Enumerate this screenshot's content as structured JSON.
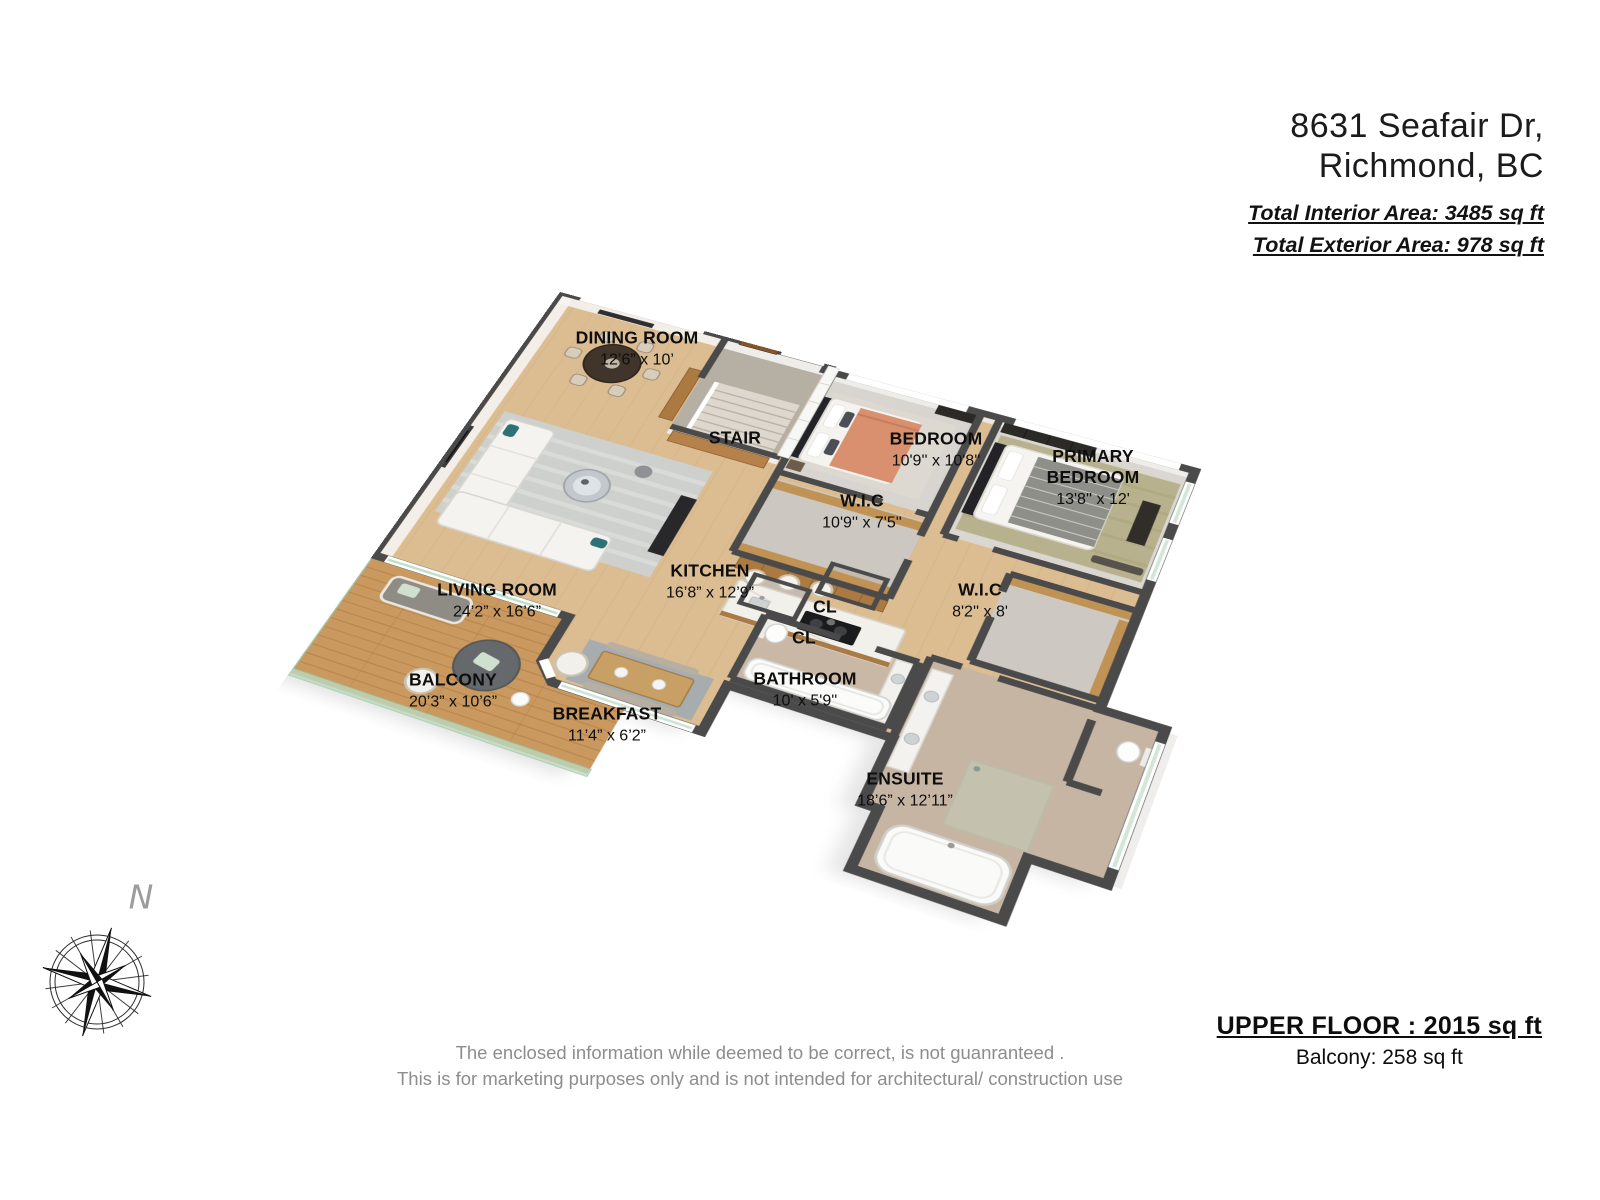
{
  "header": {
    "address_line1": "8631 Seafair Dr,",
    "address_line2": "Richmond, BC",
    "total_interior": "Total Interior Area: 3485 sq ft",
    "total_exterior": "Total Exterior Area: 978 sq ft"
  },
  "rooms": [
    {
      "name": "DINING ROOM",
      "dims": "12’6” x 10’"
    },
    {
      "name": "STAIR",
      "dims": ""
    },
    {
      "name": "BEDROOM",
      "dims": "10'9'' x 10'8''"
    },
    {
      "name": "PRIMARY BEDROOM",
      "dims": "13'8'' x 12'"
    },
    {
      "name": "W.I.C",
      "dims": "10'9'' x 7'5''"
    },
    {
      "name": "LIVING ROOM",
      "dims": "24’2” x 16’6”"
    },
    {
      "name": "KITCHEN",
      "dims": "16’8” x 12’9”"
    },
    {
      "name": "W.I.C",
      "dims": "8'2'' x 8'"
    },
    {
      "name": "CL",
      "dims": ""
    },
    {
      "name": "CL",
      "dims": ""
    },
    {
      "name": "BALCONY",
      "dims": "20’3” x 10’6”"
    },
    {
      "name": "BATHROOM",
      "dims": "10' x 5'9''"
    },
    {
      "name": "BREAKFAST",
      "dims": "11’4” x 6’2”"
    },
    {
      "name": "ENSUITE",
      "dims": "18’6” x 12’11”"
    }
  ],
  "footer": {
    "floor_title": "UPPER FLOOR : 2015 sq ft",
    "floor_subtitle": "Balcony: 258 sq ft",
    "disclaimer1": "The enclosed information while deemed to be correct, is not guanranteed .",
    "disclaimer2": "This is for marketing purposes only and is not intended for architectural/ construction use"
  },
  "compass": {
    "north_label": "N"
  },
  "colors": {
    "wall": "#4a4a4a",
    "wood_floor": "#dcbd92",
    "deck": "#c9995f",
    "carpet": "#d8d5d0",
    "tile": "#c9b7a6",
    "glass": "#bcd9c2"
  }
}
